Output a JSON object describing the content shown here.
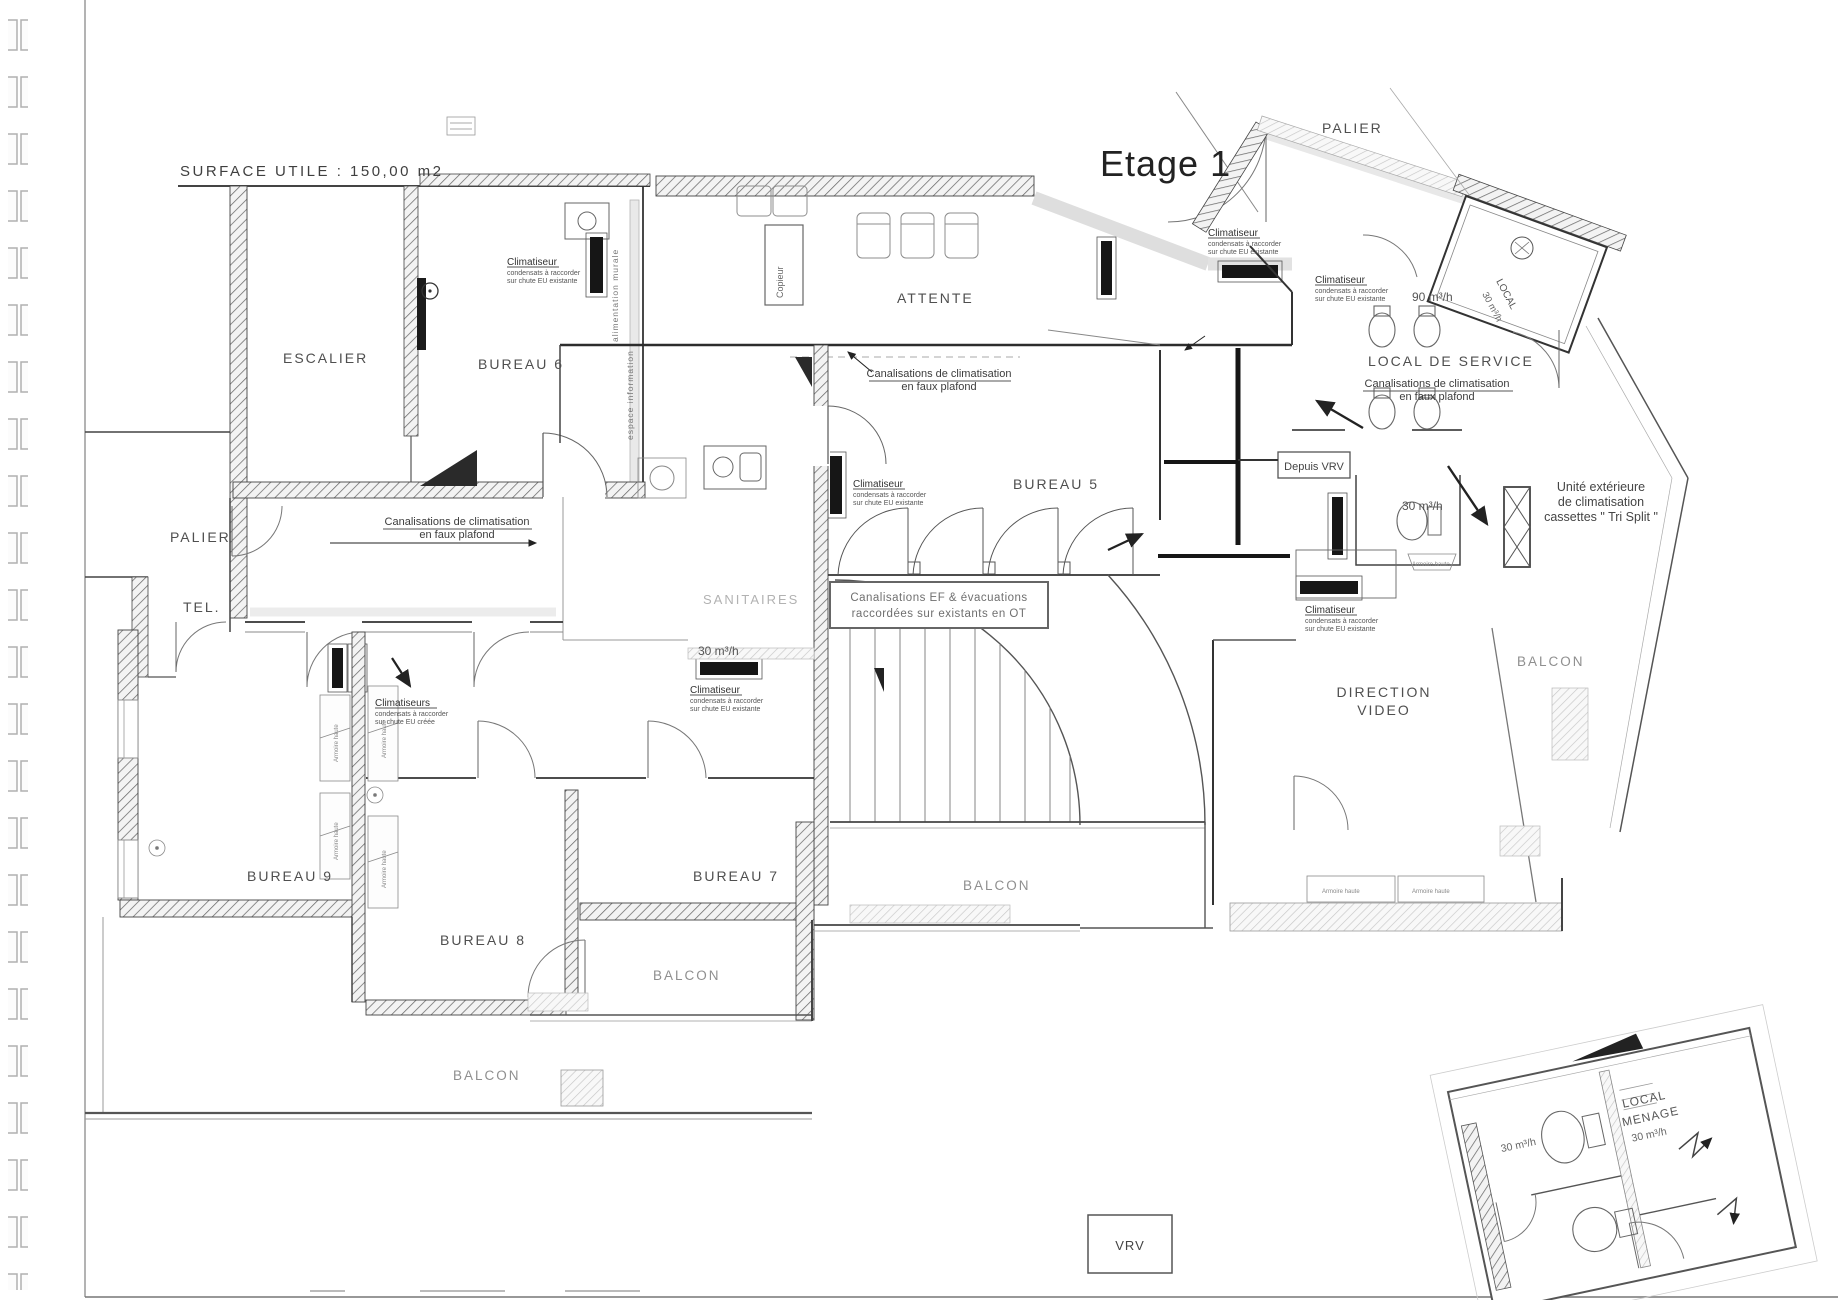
{
  "header": {
    "surface_utile": "SURFACE UTILE : 150,00 m2",
    "title": "Etage 1"
  },
  "rooms": {
    "palier": "PALIER",
    "escalier": "ESCALIER",
    "bureau6": "BUREAU 6",
    "attente": "ATTENTE",
    "local_de_service": "LOCAL DE SERVICE",
    "bureau5": "BUREAU 5",
    "tel": "TEL.",
    "sanitaires": "SANITAIRES",
    "bureau9": "BUREAU 9",
    "bureau8": "BUREAU 8",
    "bureau7": "BUREAU 7",
    "direction_line1": "DIRECTION",
    "direction_line2": "VIDEO",
    "balcon": "BALCON",
    "local": "LOCAL",
    "menage": "MENAGE"
  },
  "hvac": {
    "climatiseur": "Climatiseur",
    "climatiseurs": "Climatiseurs",
    "raccord_line": "condensats à raccorder",
    "raccord_existante": "sur chute EU existante",
    "raccord_creee": "sur chute EU créée",
    "canalisations_line1": "Canalisations de climatisation",
    "canalisations_line2": "en faux plafond",
    "canal_ef_line1": "Canalisations EF & évacuations",
    "canal_ef_line2": "raccordées sur existants en OT",
    "unite_line1": "Unité extérieure",
    "unite_line2": "de climatisation",
    "unite_line3": "cassettes \" Tri Split \"",
    "depuis_vrv": "Depuis VRV",
    "vrv": "VRV",
    "flow_90": "90 m³/h",
    "flow_30": "30 m³/h"
  },
  "furniture": {
    "copieur": "Copieur",
    "armoire_haute": "Armoire haute",
    "espace_information": "espace information",
    "alimentation_murale": "alimentation murale"
  }
}
